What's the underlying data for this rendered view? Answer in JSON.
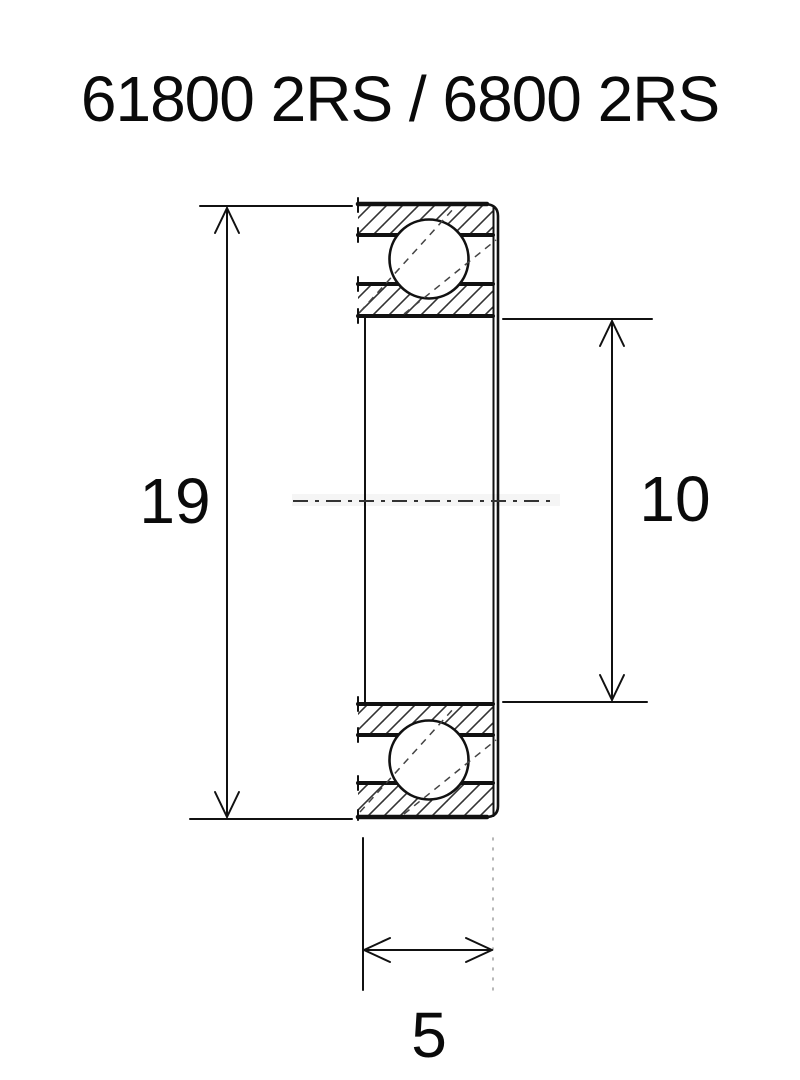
{
  "title": "61800 2RS / 6800 2RS",
  "dimensions": {
    "outer_diameter": {
      "label": "19"
    },
    "bore_diameter": {
      "label": "10"
    },
    "width": {
      "label": "5"
    }
  },
  "drawing": {
    "line_color": "#111111",
    "hatch_color": "#333333",
    "background_color": "#ffffff"
  }
}
